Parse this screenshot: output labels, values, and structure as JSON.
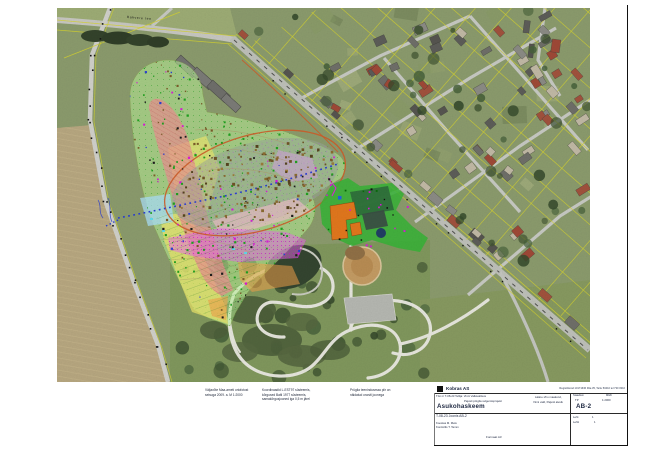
{
  "page": {
    "background": "#ffffff",
    "frame_color": "#111111"
  },
  "map": {
    "road_label": "Rakvere tee",
    "legend_notes": [
      {
        "lines": [
          "Väljavõte Maa-ameti ortofotost",
          "seisuga 2009. a.  M 1:2000"
        ]
      },
      {
        "lines": [
          "Koordinaadid L-EST97 süsteemis,",
          "kõrgused Balti 1977 süsteemis,",
          "samakõrgusjooned iga 0,5 m järel"
        ]
      },
      {
        "lines": [
          "Prügila teenindusmaa piir on",
          "näidatud oranži joonega"
        ]
      }
    ],
    "colors": {
      "overlay_green": "#b9f096",
      "overlay_yellow": "#f5e96a",
      "overlay_salmon": "#e89090",
      "overlay_magenta": "#e86ae8",
      "overlay_pink": "#f6bcd0",
      "overlay_blue": "#a8dcf4",
      "overlay_orange": "#f0a048",
      "facility_green": "#35b335",
      "building_orange": "#e0761c",
      "boundary_orange": "#cc5c28",
      "parcel_yellow": "#d4d22e"
    }
  },
  "title_block": {
    "logo_text": "Kobras AS",
    "logo_info": "Registrikood 10171636  Riia 35, Tartu 50410  tel 730 0310",
    "work_no_line": "Töö nr T-08-23   Tellija: Vinni Vallavalitsus",
    "work_sub_line": "Pajusti prügila sulgemisprojekt",
    "drawing_title": "Asukohaskeem",
    "location_line1": "Lääne-Viru maakond,",
    "location_line2": "Vinni vald, Pajusti alevik",
    "stage_label": "Staadium",
    "stage_value": "TP",
    "scale_label": "Mõõt",
    "scale_value": "1:2000",
    "drawing_no": "AB-2",
    "doc_line": "T-08-23  Joonis AB-2",
    "author_line1": "Koostas   M. Mets",
    "author_line2": "Kontrollis   T. Tamm",
    "sheet_label": "Leht",
    "sheet_value": "1",
    "sheets_label": "Lehti",
    "sheets_value": "1",
    "format_note": "Formaat A3"
  }
}
